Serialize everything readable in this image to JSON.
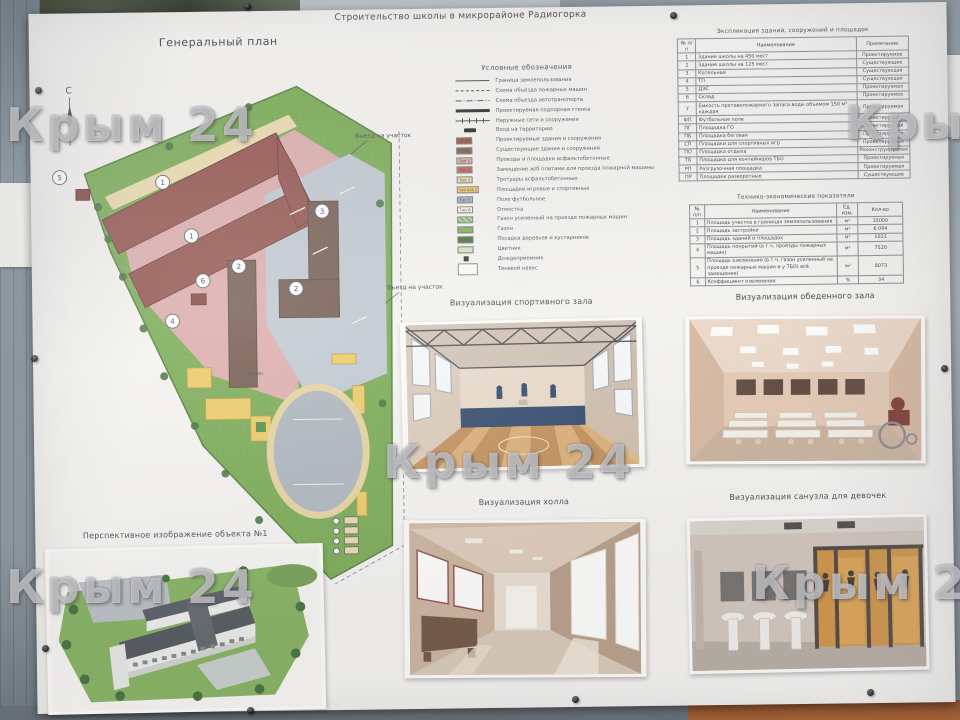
{
  "board": {
    "title": "Строительство школы в микрорайоне Радиогорка"
  },
  "watermark": {
    "text": "Крым 24"
  },
  "genplan": {
    "heading": "Генеральный план",
    "compass": "С",
    "labels": {
      "exit": "Выезд на участок",
      "entry": "Въезд на участок"
    },
    "elevations": [
      "95.100",
      "95.100"
    ],
    "markers": [
      {
        "n": "1",
        "x": 113,
        "y": 106
      },
      {
        "n": "1",
        "x": 141,
        "y": 160
      },
      {
        "n": "2",
        "x": 188,
        "y": 191
      },
      {
        "n": "2",
        "x": 245,
        "y": 214
      },
      {
        "n": "3",
        "x": 272,
        "y": 137
      },
      {
        "n": "4",
        "x": 121,
        "y": 245
      },
      {
        "n": "5",
        "x": 10,
        "y": 100
      },
      {
        "n": "6",
        "x": 152,
        "y": 205
      }
    ]
  },
  "legend": {
    "heading": "Условные обозначения",
    "items": [
      {
        "swatch": "line",
        "label": "Граница землепользования"
      },
      {
        "swatch": "dash",
        "label": "Схема объезда пожарных машин"
      },
      {
        "swatch": "dashdot",
        "label": "Схема объезда автотранспорта"
      },
      {
        "swatch": "thick",
        "label": "Проектируемая подпорная стенка"
      },
      {
        "swatch": "tick",
        "label": "Наружные сети и сооружения"
      },
      {
        "swatch": "entry",
        "label": "Вход на территорию"
      },
      {
        "swatch": "box",
        "color": "#8e4a43",
        "label": "Проектируемые здания и сооружения"
      },
      {
        "swatch": "box",
        "color": "#6d5c50",
        "label": "Существующие здания и сооружения"
      },
      {
        "swatch": "box",
        "color": "#dda8a4",
        "tag": "Тип 1",
        "label": "Проезды и площадки асфальтобетонные"
      },
      {
        "swatch": "box",
        "color": "#c05f52",
        "tag": "Тип 2",
        "label": "Замощение ж/б плитами для проезда пожарной машины"
      },
      {
        "swatch": "box",
        "color": "#e8d7a6",
        "tag": "Тип 3",
        "label": "Тротуары асфальтобетонные"
      },
      {
        "swatch": "box",
        "color": "#eec75e",
        "tag": "Тип 4/4.1",
        "label": "Площадки игровые и спортивные"
      },
      {
        "swatch": "box",
        "color": "#9fb0bd",
        "tag": "Тип 5",
        "label": "Поле футбольное"
      },
      {
        "swatch": "box",
        "color": "#f4f2ec",
        "tag": "Тип 6",
        "label": "Отмостка"
      },
      {
        "swatch": "hatch",
        "label": "Газон усиленный на проезде пожарных машин"
      },
      {
        "swatch": "box",
        "color": "#7cab57",
        "label": "Газон"
      },
      {
        "swatch": "box",
        "color": "#3f6d35",
        "label": "Посадка деревьев и кустарников"
      },
      {
        "swatch": "box",
        "color": "#cfe3bd",
        "label": "Цветник"
      },
      {
        "swatch": "dot",
        "label": "Дождеприемник"
      },
      {
        "swatch": "shed",
        "label": "Теневой навес"
      }
    ]
  },
  "explication": {
    "title": "Экспликация зданий, сооружений и площадок",
    "columns": [
      "№ п/п",
      "Наименование",
      "Примечание"
    ],
    "rows": [
      [
        "1",
        "Здание школы на 450 мест",
        "Проектируемое"
      ],
      [
        "2",
        "Здание школы на 125 мест",
        "Существующее"
      ],
      [
        "3",
        "Котельная",
        "Существующая"
      ],
      [
        "4",
        "ТП",
        "Существующая"
      ],
      [
        "5",
        "ДЭС",
        "Проектируемая"
      ],
      [
        "6",
        "Склад",
        "Проектируемое"
      ],
      [
        "7",
        "Емкость противопожарного запаса воды объемом 150 м³ каждая",
        "Проектируемая"
      ],
      [
        "ФП",
        "Футбольное поле",
        "Проектируемое"
      ],
      [
        "ПГ",
        "Площадка ГО",
        "Проектируемая"
      ],
      [
        "ПБ",
        "Площадка беговая",
        "Проектируемая"
      ],
      [
        "СП",
        "Площадки для спортивных игр",
        "Проектируемые"
      ],
      [
        "ПО",
        "Площадка отдыха",
        "Реконструируемая"
      ],
      [
        "ТБ",
        "Площадка для контейнеров ТБО",
        "Проектируемая"
      ],
      [
        "РП",
        "Разгрузочная площадка",
        "Проектируемая"
      ],
      [
        "ПР",
        "Площадки разворотные",
        "Существующие"
      ]
    ]
  },
  "tep": {
    "title": "Технико-экономические показатели",
    "columns": [
      "№ п/п",
      "Наименование",
      "Ед. изм.",
      "Кол-во"
    ],
    "rows": [
      [
        "1",
        "Площадь участка в границах землепользования",
        "м²",
        "35000"
      ],
      [
        "2",
        "Площадь застройки",
        "м²",
        "6 094"
      ],
      [
        "3",
        "Площадь зданий и площадок",
        "м²",
        "1021"
      ],
      [
        "4",
        "Площадь покрытий (в т.ч. проезды пожарных машин)",
        "м²",
        "7520"
      ],
      [
        "5",
        "Площадь озеленения (в т.ч. газон усиленный на проезде пожарных машин и у ТБО) всё замощение)",
        "м²",
        "8073"
      ],
      [
        "6",
        "Коэффициент озеленения",
        "%",
        "34"
      ]
    ]
  },
  "visualizations": [
    {
      "caption": "Визуализация спортивного зала"
    },
    {
      "caption": "Визуализация обеденного зала"
    },
    {
      "caption": "Визуализация холла"
    },
    {
      "caption": "Визуализация санузла для девочек"
    }
  ],
  "perspective": {
    "caption": "Перспективное изображение объекта №1"
  }
}
